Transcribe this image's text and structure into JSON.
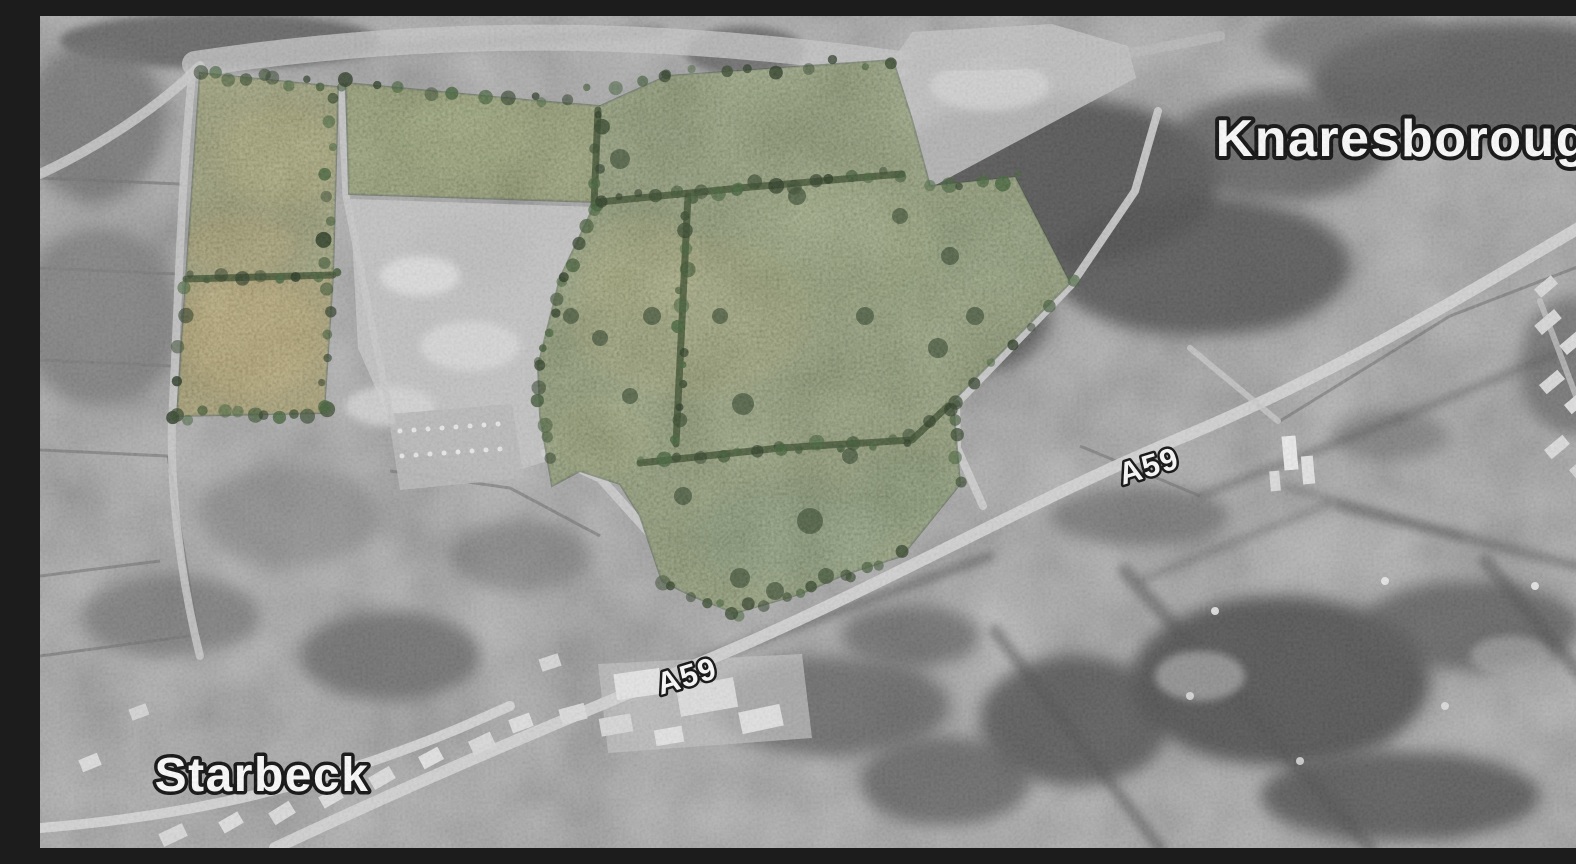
{
  "meta": {
    "width": 1576,
    "height": 832,
    "title": "Grayscale aerial photograph with highlighted green site fields between Starbeck and Knaresborough"
  },
  "colors": {
    "base": "#989898",
    "label_fill": "#ffffff",
    "label_stroke": "#000000",
    "hedge": "#2e421f",
    "parcel_outline": "#2f4526",
    "tree_shades": [
      "#2c4022",
      "#35502a",
      "#1f3018",
      "#3c5c31"
    ]
  },
  "labels": [
    {
      "id": "knaresborough",
      "text": "Knaresborough",
      "x": 1379,
      "y": 140,
      "size": 52,
      "rot": 0
    },
    {
      "id": "starbeck",
      "text": "Starbeck",
      "x": 222,
      "y": 775,
      "size": 48,
      "rot": 0
    },
    {
      "id": "a59-east",
      "text": "A59",
      "x": 1112,
      "y": 460,
      "size": 31,
      "rot": -17
    },
    {
      "id": "a59-west",
      "text": "A59",
      "x": 650,
      "y": 670,
      "size": 31,
      "rot": -17
    }
  ],
  "parcels": [
    {
      "id": "site-parcel-left-upper",
      "fill": "#7c813f",
      "points": "160,57 298,71 293,259 146,263"
    },
    {
      "id": "site-parcel-left-lower",
      "fill": "#8e8139",
      "points": "146,263 293,259 284,397 137,400"
    },
    {
      "id": "site-parcel-strip-west",
      "fill": "#71803c",
      "points": "306,67 497,85 560,90 556,186 309,178"
    },
    {
      "id": "site-parcel-central",
      "fill": "#6b7d41",
      "points": "560,90 627,60 853,44 872,104 890,170 975,161 1030,267 913,385 920,468 862,540 806,558 760,578 695,597 652,580 622,565 600,500 580,468 540,455 512,470 500,400 498,350 520,262 553,192 557,158"
    }
  ],
  "hedges": [
    {
      "pts": [
        [
          146,
          263
        ],
        [
          293,
          259
        ]
      ]
    },
    {
      "pts": [
        [
          558,
          94
        ],
        [
          554,
          190
        ]
      ]
    },
    {
      "pts": [
        [
          560,
          186
        ],
        [
          700,
          172
        ],
        [
          862,
          158
        ]
      ]
    },
    {
      "pts": [
        [
          648,
          180
        ],
        [
          636,
          428
        ]
      ]
    },
    {
      "pts": [
        [
          600,
          447
        ],
        [
          740,
          432
        ],
        [
          872,
          424
        ],
        [
          908,
          390
        ]
      ]
    }
  ],
  "treelines": [
    {
      "pts": [
        [
          160,
          57
        ],
        [
          298,
          71
        ]
      ],
      "step": 14
    },
    {
      "pts": [
        [
          137,
          400
        ],
        [
          284,
          397
        ]
      ],
      "step": 14
    },
    {
      "pts": [
        [
          291,
          85
        ],
        [
          285,
          392
        ]
      ],
      "step": 22
    },
    {
      "pts": [
        [
          306,
          67
        ],
        [
          497,
          85
        ],
        [
          627,
          60
        ],
        [
          853,
          44
        ]
      ],
      "step": 26
    },
    {
      "pts": [
        [
          553,
          192
        ],
        [
          520,
          262
        ],
        [
          498,
          350
        ],
        [
          508,
          442
        ]
      ],
      "step": 18
    },
    {
      "pts": [
        [
          620,
          565
        ],
        [
          695,
          597
        ],
        [
          806,
          558
        ],
        [
          862,
          540
        ]
      ],
      "step": 16
    },
    {
      "pts": [
        [
          913,
          385
        ],
        [
          920,
          462
        ]
      ],
      "step": 18
    },
    {
      "pts": [
        [
          890,
          170
        ],
        [
          975,
          161
        ]
      ],
      "step": 16
    },
    {
      "pts": [
        [
          144,
          268
        ],
        [
          138,
          396
        ]
      ],
      "step": 26
    },
    {
      "pts": [
        [
          1030,
          267
        ],
        [
          913,
          385
        ]
      ],
      "step": 24
    }
  ],
  "trees": [
    [
      580,
      143,
      10
    ],
    [
      612,
      300,
      9
    ],
    [
      703,
      388,
      11
    ],
    [
      770,
      505,
      13
    ],
    [
      825,
      300,
      9
    ],
    [
      898,
      332,
      10
    ],
    [
      643,
      480,
      9
    ],
    [
      700,
      562,
      10
    ],
    [
      531,
      300,
      8
    ],
    [
      560,
      322,
      8
    ],
    [
      757,
      180,
      9
    ],
    [
      860,
      200,
      8
    ],
    [
      910,
      240,
      9
    ],
    [
      935,
      300,
      9
    ],
    [
      590,
      380,
      8
    ],
    [
      680,
      300,
      8
    ],
    [
      735,
      575,
      9
    ],
    [
      810,
      440,
      8
    ]
  ],
  "greenBlobs": [
    [
      210,
      320,
      70,
      60,
      "#b5953c",
      0.5
    ],
    [
      240,
      140,
      60,
      50,
      "#a89a40",
      0.35
    ],
    [
      420,
      120,
      70,
      35,
      "#8ba04b",
      0.3
    ],
    [
      650,
      300,
      120,
      80,
      "#97933f",
      0.3
    ],
    [
      800,
      230,
      100,
      70,
      "#7f9a4a",
      0.25
    ],
    [
      600,
      250,
      60,
      50,
      "#a3a04b",
      0.3
    ],
    [
      950,
      230,
      60,
      45,
      "#5c7a3e",
      0.35
    ],
    [
      750,
      520,
      100,
      50,
      "#4f7340",
      0.4
    ],
    [
      870,
      480,
      60,
      40,
      "#557a40",
      0.35
    ],
    [
      560,
      420,
      50,
      40,
      "#8f9a48",
      0.3
    ],
    [
      200,
      230,
      55,
      30,
      "#b08f3e",
      0.4
    ]
  ],
  "woods": [
    [
      1010,
      165,
      170,
      85,
      "#474747",
      0.9,
      8
    ],
    [
      1160,
      250,
      150,
      70,
      "#474747",
      0.85,
      8
    ],
    [
      940,
      300,
      70,
      55,
      "#4a4a4a",
      0.8,
      8
    ],
    [
      1240,
      130,
      110,
      55,
      "#525252",
      0.8,
      8
    ],
    [
      1460,
      65,
      190,
      60,
      "#4b4b4b",
      0.85,
      8
    ],
    [
      1310,
      25,
      90,
      35,
      "#616161",
      0.7,
      8
    ],
    [
      1240,
      665,
      150,
      85,
      "#454545",
      0.9,
      8
    ],
    [
      1035,
      705,
      95,
      65,
      "#4a4a4a",
      0.85,
      8
    ],
    [
      1430,
      610,
      110,
      45,
      "#515151",
      0.8,
      8
    ],
    [
      1360,
      780,
      140,
      45,
      "#484848",
      0.85,
      8
    ],
    [
      905,
      765,
      85,
      45,
      "#555555",
      0.8,
      8
    ],
    [
      705,
      35,
      60,
      25,
      "#5a5a5a",
      0.8,
      4
    ],
    [
      180,
      25,
      160,
      28,
      "#565656",
      0.85,
      4
    ],
    [
      55,
      105,
      70,
      80,
      "#6a6a6a",
      0.8,
      8
    ],
    [
      60,
      300,
      80,
      90,
      "#757575",
      0.8,
      8
    ],
    [
      430,
      235,
      60,
      35,
      "#6f6f6f",
      0.7,
      8
    ],
    [
      350,
      640,
      90,
      45,
      "#5e5e5e",
      0.8,
      8
    ],
    [
      130,
      600,
      90,
      40,
      "#6b6b6b",
      0.7,
      8
    ],
    [
      790,
      690,
      120,
      50,
      "#595959",
      0.8,
      8
    ],
    [
      1100,
      500,
      90,
      30,
      "#606060",
      0.7,
      8
    ],
    [
      1350,
      420,
      60,
      25,
      "#636363",
      0.6,
      8
    ],
    [
      870,
      620,
      70,
      30,
      "#575757",
      0.7,
      8
    ],
    [
      480,
      540,
      70,
      35,
      "#6e6e6e",
      0.6,
      8
    ],
    [
      250,
      500,
      90,
      50,
      "#7a7a7a",
      0.6,
      8
    ],
    [
      1530,
      350,
      50,
      70,
      "#585858",
      0.7,
      8
    ]
  ],
  "darkLines": [
    [
      1085,
      555,
      1330,
      832,
      14,
      0.5
    ],
    [
      1445,
      545,
      1576,
      700,
      14,
      0.5
    ],
    [
      955,
      615,
      1120,
      832,
      12,
      0.5
    ],
    [
      1300,
      490,
      1576,
      560,
      10,
      0.45
    ],
    [
      660,
      645,
      950,
      540,
      10,
      0.5
    ],
    [
      150,
      45,
      620,
      15,
      10,
      0.45
    ],
    [
      1160,
      480,
      1360,
      402,
      7,
      0.5
    ],
    [
      1360,
      402,
      1530,
      332,
      7,
      0.45
    ],
    [
      1244,
      470,
      1420,
      520,
      6,
      0.4
    ],
    [
      1100,
      565,
      1290,
      487,
      6,
      0.4
    ]
  ],
  "roads": [
    {
      "d": "M 235,832 C 420,745 560,690 705,628 C 860,560 1000,480 1150,418 C 1300,355 1440,270 1576,190",
      "w": 12,
      "c": "#d4d4d4",
      "o": 0.95
    },
    {
      "d": "M 155,48 C 420,8 640,18 860,48",
      "w": 26,
      "c": "#c6c6c6",
      "o": 0.8
    },
    {
      "d": "M 160,50 C 120,90 60,130 0,158",
      "w": 10,
      "c": "#cdcdcd",
      "o": 0.85
    },
    {
      "d": "M 152,60 C 140,180 138,300 132,405 C 130,470 140,560 160,640",
      "w": 8,
      "c": "#c9c9c9",
      "o": 0.85
    },
    {
      "d": "M 301,72 L 306,180 L 330,300 L 352,405",
      "w": 7,
      "c": "#c9c9c9",
      "o": 0.85
    },
    {
      "d": "M 943,490 L 917,432 L 916,388 L 1032,268 L 1095,175 L 1118,95",
      "w": 8,
      "c": "#cfcfcf",
      "o": 0.9
    },
    {
      "d": "M 0,812 C 150,800 280,770 420,712 L 470,690",
      "w": 10,
      "c": "#d6d6d6",
      "o": 0.95
    },
    {
      "d": "M 505,437 L 560,462 L 612,520 L 650,573 L 688,590",
      "w": 9,
      "c": "#cfcfcf",
      "o": 0.85
    },
    {
      "d": "M 1150,332 L 1238,405",
      "w": 6,
      "c": "#c8c8c8",
      "o": 0.8
    },
    {
      "d": "M 1500,285 L 1555,430",
      "w": 6,
      "c": "#c8c8c8",
      "o": 0.7
    },
    {
      "d": "M 860,48 C 1000,55 1080,40 1180,20",
      "w": 10,
      "c": "#bdbdbd",
      "o": 0.6
    }
  ],
  "lightAreas": [
    {
      "poly": "310,183 556,191 522,265 498,352 508,445 452,462 362,432 318,332",
      "fill": "#c4c4c4",
      "o": 0.9
    },
    {
      "ellipse": [
        380,
        260,
        40,
        20
      ],
      "fill": "#e3e3e3",
      "o": 0.8,
      "blur": 4
    },
    {
      "ellipse": [
        430,
        330,
        50,
        25
      ],
      "fill": "#dcdcdc",
      "o": 0.8,
      "blur": 4
    },
    {
      "ellipse": [
        350,
        390,
        45,
        20
      ],
      "fill": "#d8d8d8",
      "o": 0.8,
      "blur": 4
    },
    {
      "poly": "853,44 872,16 1012,8 1088,30 1096,62 890,172",
      "fill": "#c2c2c2",
      "o": 0.85
    },
    {
      "ellipse": [
        950,
        70,
        60,
        25
      ],
      "fill": "#d9d9d9",
      "o": 0.7,
      "blur": 4
    },
    {
      "poly": "348,398 472,388 484,462 360,474",
      "fill": "#b8b8b8",
      "o": 0.9
    },
    {
      "poly": "558,648 762,638 772,722 568,737",
      "fill": "#c0c0c0",
      "o": 0.7
    },
    {
      "ellipse": [
        1160,
        660,
        45,
        25
      ],
      "fill": "#a8a8a8",
      "o": 0.7,
      "blur": 4
    },
    {
      "ellipse": [
        1470,
        640,
        40,
        20
      ],
      "fill": "#ababab",
      "o": 0.6,
      "blur": 4
    }
  ],
  "buildings": [
    [
      575,
      655,
      46,
      26,
      -8,
      "#e6e6e6"
    ],
    [
      638,
      666,
      58,
      30,
      -10,
      "#dedede"
    ],
    [
      700,
      692,
      42,
      22,
      -12,
      "#e2e2e2"
    ],
    [
      560,
      700,
      32,
      18,
      -10,
      "#d8d8d8"
    ],
    [
      615,
      712,
      28,
      16,
      -10,
      "#e4e4e4"
    ],
    [
      520,
      690,
      26,
      16,
      -15,
      "#dcdcdc"
    ],
    [
      470,
      700,
      22,
      14,
      -20,
      "#e0e0e0"
    ],
    [
      430,
      720,
      24,
      15,
      -25,
      "#dadada"
    ],
    [
      380,
      735,
      22,
      14,
      -28,
      "#e3e3e3"
    ],
    [
      330,
      755,
      24,
      14,
      -30,
      "#dddddd"
    ],
    [
      280,
      775,
      22,
      13,
      -30,
      "#e1e1e1"
    ],
    [
      230,
      790,
      24,
      14,
      -32,
      "#dcdcdc"
    ],
    [
      180,
      800,
      22,
      13,
      -30,
      "#e0e0e0"
    ],
    [
      120,
      812,
      26,
      14,
      -25,
      "#d9d9d9"
    ],
    [
      90,
      690,
      18,
      12,
      -20,
      "#d5d5d5"
    ],
    [
      40,
      740,
      20,
      13,
      -22,
      "#dedede"
    ],
    [
      500,
      640,
      20,
      13,
      -18,
      "#d7d7d7"
    ],
    [
      1243,
      420,
      14,
      34,
      -5,
      "#ececec"
    ],
    [
      1262,
      440,
      12,
      28,
      -5,
      "#e4e4e4"
    ],
    [
      1230,
      455,
      10,
      20,
      -5,
      "#dcdcdc"
    ],
    [
      1495,
      300,
      26,
      12,
      -40,
      "#d8d8d8"
    ],
    [
      1520,
      320,
      26,
      12,
      -40,
      "#dddddd"
    ],
    [
      1545,
      340,
      26,
      12,
      -40,
      "#d6d6d6"
    ],
    [
      1500,
      360,
      24,
      12,
      -40,
      "#dadada"
    ],
    [
      1525,
      380,
      24,
      12,
      -40,
      "#e0e0e0"
    ],
    [
      1550,
      400,
      24,
      12,
      -40,
      "#d8d8d8"
    ],
    [
      1505,
      425,
      24,
      12,
      -40,
      "#dcdcdc"
    ],
    [
      1530,
      445,
      24,
      12,
      -40,
      "#d4d4d4"
    ],
    [
      1495,
      265,
      22,
      11,
      -40,
      "#d9d9d9"
    ],
    [
      1555,
      300,
      20,
      11,
      -40,
      "#e2e2e2"
    ]
  ],
  "dots": [
    [
      1175,
      595,
      4,
      "#ededed",
      0.9
    ],
    [
      1345,
      565,
      4,
      "#ededed",
      0.9
    ],
    [
      1495,
      570,
      4,
      "#ededed",
      0.9
    ],
    [
      1405,
      690,
      4,
      "#e8e8e8",
      0.8
    ],
    [
      1260,
      745,
      4,
      "#e8e8e8",
      0.8
    ],
    [
      1150,
      680,
      4,
      "#e8e8e8",
      0.8
    ],
    [
      360,
      415,
      2.5,
      "#f0f0f0",
      0.9
    ],
    [
      374,
      414,
      2.5,
      "#f0f0f0",
      0.9
    ],
    [
      388,
      413,
      2.5,
      "#f0f0f0",
      0.9
    ],
    [
      402,
      412,
      2.5,
      "#f0f0f0",
      0.9
    ],
    [
      416,
      411,
      2.5,
      "#f0f0f0",
      0.9
    ],
    [
      430,
      410,
      2.5,
      "#f0f0f0",
      0.9
    ],
    [
      444,
      409,
      2.5,
      "#f0f0f0",
      0.9
    ],
    [
      458,
      408,
      2.5,
      "#f0f0f0",
      0.9
    ],
    [
      362,
      440,
      2.5,
      "#f0f0f0",
      0.9
    ],
    [
      376,
      439,
      2.5,
      "#f0f0f0",
      0.9
    ],
    [
      390,
      438,
      2.5,
      "#f0f0f0",
      0.9
    ],
    [
      404,
      437,
      2.5,
      "#f0f0f0",
      0.9
    ],
    [
      418,
      436,
      2.5,
      "#f0f0f0",
      0.9
    ],
    [
      432,
      435,
      2.5,
      "#f0f0f0",
      0.9
    ],
    [
      446,
      434,
      2.5,
      "#f0f0f0",
      0.9
    ],
    [
      460,
      433,
      2.5,
      "#f0f0f0",
      0.9
    ]
  ],
  "fieldLines": [
    [
      0,
      162,
      140,
      168
    ],
    [
      0,
      252,
      138,
      258
    ],
    [
      0,
      344,
      132,
      350
    ],
    [
      0,
      434,
      128,
      440
    ],
    [
      128,
      440,
      158,
      620
    ],
    [
      1040,
      430,
      1160,
      480
    ],
    [
      470,
      472,
      560,
      520
    ],
    [
      350,
      455,
      470,
      472
    ],
    [
      0,
      560,
      120,
      545
    ],
    [
      0,
      640,
      150,
      620
    ],
    [
      1240,
      405,
      1410,
      300
    ],
    [
      1410,
      300,
      1540,
      250
    ]
  ]
}
